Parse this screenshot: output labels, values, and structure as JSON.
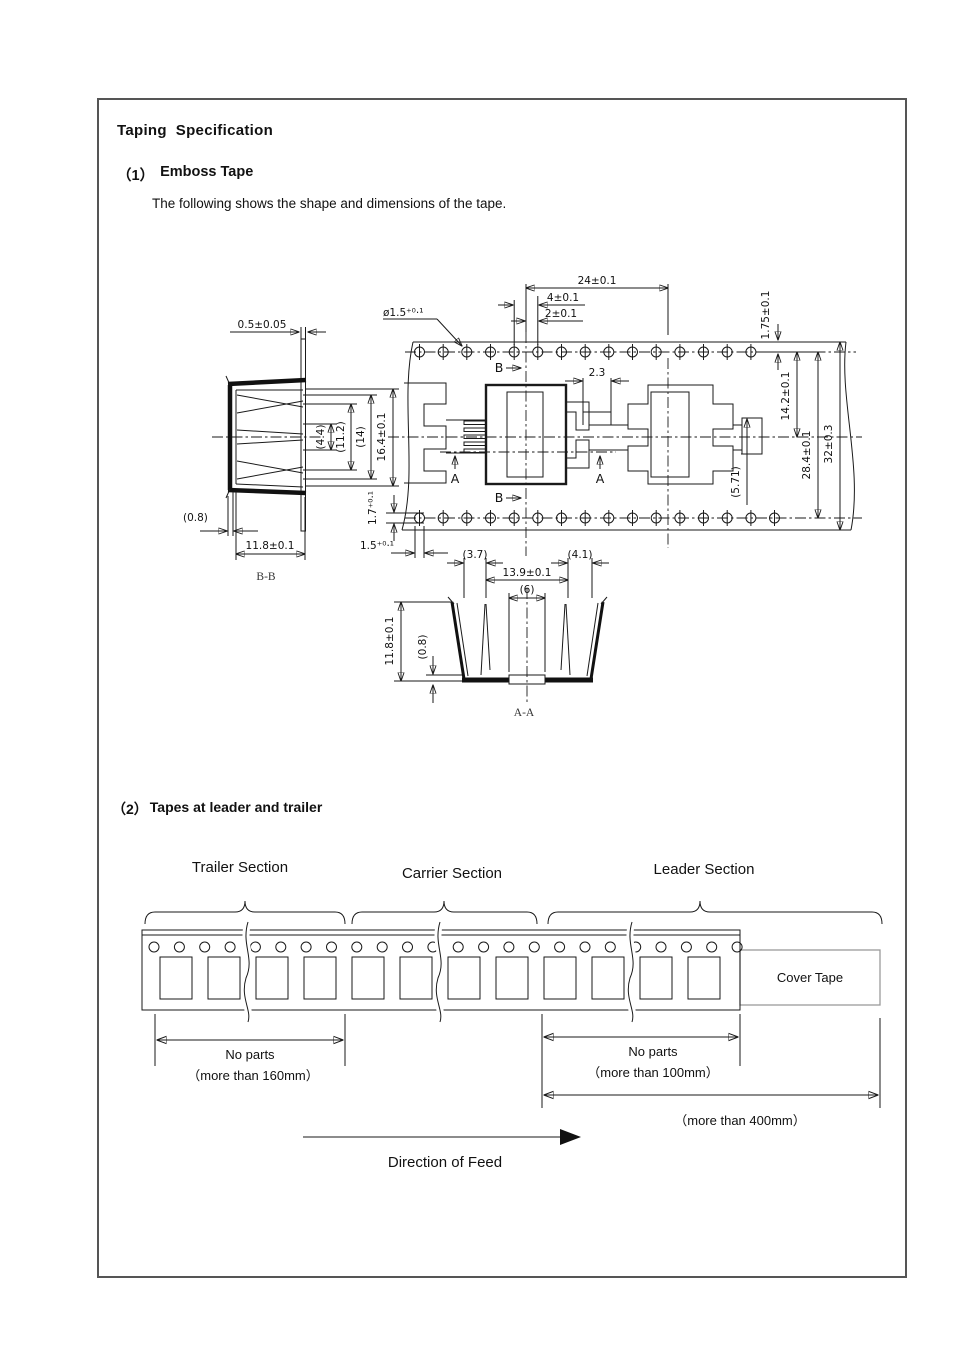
{
  "page": {
    "title": "Taping  Specification",
    "section1": {
      "number": "（1）",
      "heading": "Emboss Tape",
      "description": "The following shows the shape and dimensions of the tape."
    },
    "section2": {
      "number": "（2）",
      "heading": "Tapes at leader and trailer"
    }
  },
  "emboss": {
    "flange_thickness": "0.5±0.05",
    "pocket_pitch": "24±0.1",
    "hole_pitch": "4±0.1",
    "hole_offset": "2±0.1",
    "hole_diameter": "ø1.5⁺⁰·¹",
    "edge_to_hole": "1.75±0.1",
    "hole_to_centerline": "14.2±0.1",
    "hole_row_span": "28.4±0.1",
    "tape_width": "32±0.3",
    "notch_width": "2.3",
    "tab_depth": "(5.71)",
    "slot_height": "1.7⁺⁰·¹",
    "slot_width": "1.5⁺⁰·¹",
    "marker_a": "A",
    "marker_b": "B",
    "bb": {
      "label": "B-B",
      "w1": "(4.4)",
      "w2": "(11.2)",
      "w3": "(14)",
      "w4": "16.4±0.1",
      "wall": "(0.8)",
      "depth": "11.8±0.1"
    },
    "aa": {
      "label": "A-A",
      "left": "(3.7)",
      "right": "(4.1)",
      "cavity": "13.9±0.1",
      "window": "(6)",
      "depth": "11.8±0.1",
      "bottom": "(0.8)"
    }
  },
  "leader_trailer": {
    "trailer": "Trailer  Section",
    "carrier": "Carrier Section",
    "leader": "Leader Section",
    "cover_tape": "Cover Tape",
    "trailer_note1": "No  parts",
    "trailer_note2": "（more  than 160mm）",
    "leader_note1": "No  parts",
    "leader_note2": "（more  than 100mm）",
    "overall_note": "（more  than 400mm）",
    "feed": "Direction of Feed"
  }
}
